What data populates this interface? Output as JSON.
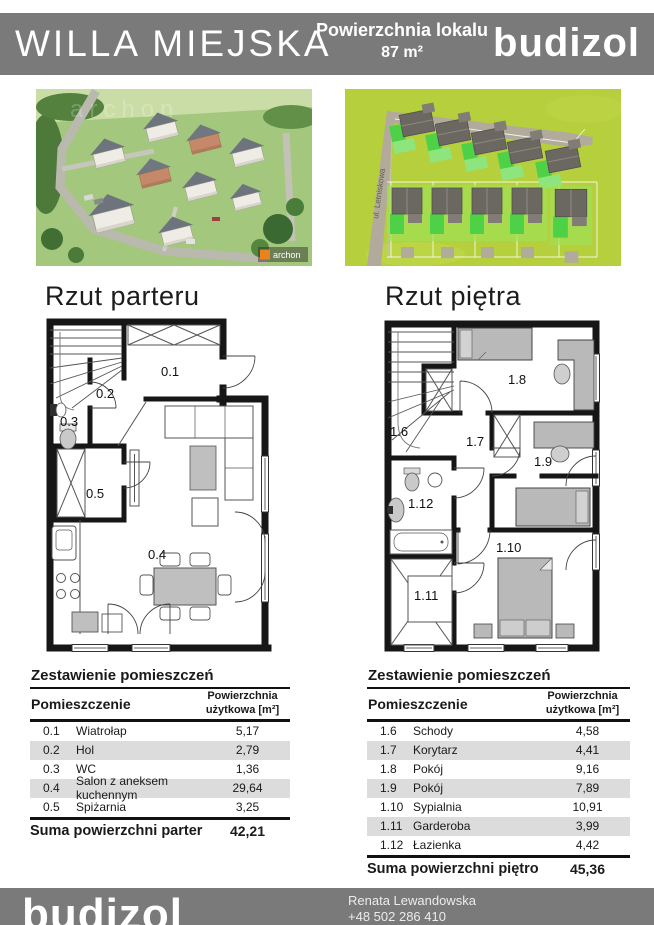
{
  "header": {
    "title": "WILLA MIEJSKA",
    "area_label": "Powierzchnia lokalu",
    "area_value": "87 m²",
    "brand": "budizol"
  },
  "images": {
    "estate": {
      "watermark": "archon"
    },
    "site": {
      "street_label": "ul. Letniskowa"
    }
  },
  "plans": [
    {
      "title": "Rzut parteru",
      "rooms": [
        "0.1",
        "0.2",
        "0.3",
        "0.4",
        "0.5"
      ]
    },
    {
      "title": "Rzut piętra",
      "rooms": [
        "1.6",
        "1.7",
        "1.8",
        "1.9",
        "1.10",
        "1.11",
        "1.12"
      ]
    }
  ],
  "tables": [
    {
      "title": "Zestawienie pomieszczeń",
      "col1": "Pomieszczenie",
      "col2": "Powierzchnia użytkowa [m²]",
      "rows": [
        {
          "no": "0.1",
          "name": "Wiatrołap",
          "area": "5,17"
        },
        {
          "no": "0.2",
          "name": "Hol",
          "area": "2,79"
        },
        {
          "no": "0.3",
          "name": "WC",
          "area": "1,36"
        },
        {
          "no": "0.4",
          "name": "Salon z aneksem kuchennym",
          "area": "29,64"
        },
        {
          "no": "0.5",
          "name": "Spiżarnia",
          "area": "3,25"
        }
      ],
      "total_label": "Suma powierzchni parter",
      "total_value": "42,21"
    },
    {
      "title": "Zestawienie pomieszczeń",
      "col1": "Pomieszczenie",
      "col2": "Powierzchnia użytkowa [m²]",
      "rows": [
        {
          "no": "1.6",
          "name": "Schody",
          "area": "4,58"
        },
        {
          "no": "1.7",
          "name": "Korytarz",
          "area": "4,41"
        },
        {
          "no": "1.8",
          "name": "Pokój",
          "area": "9,16"
        },
        {
          "no": "1.9",
          "name": "Pokój",
          "area": "7,89"
        },
        {
          "no": "1.10",
          "name": "Sypialnia",
          "area": "10,91"
        },
        {
          "no": "1.11",
          "name": "Garderoba",
          "area": "3,99"
        },
        {
          "no": "1.12",
          "name": "Łazienka",
          "area": "4,42"
        }
      ],
      "total_label": "Suma powierzchni piętro",
      "total_value": "45,36"
    }
  ],
  "footer": {
    "brand": "budizol",
    "contact_name": "Renata Lewandowska",
    "contact_phone": "+48 502 286 410"
  },
  "colors": {
    "header_bar": "#7a7a7a",
    "row_shade": "#dcdcdc",
    "site_plan_background": "#b6cf3c",
    "highlight_green": "#4fd147"
  }
}
